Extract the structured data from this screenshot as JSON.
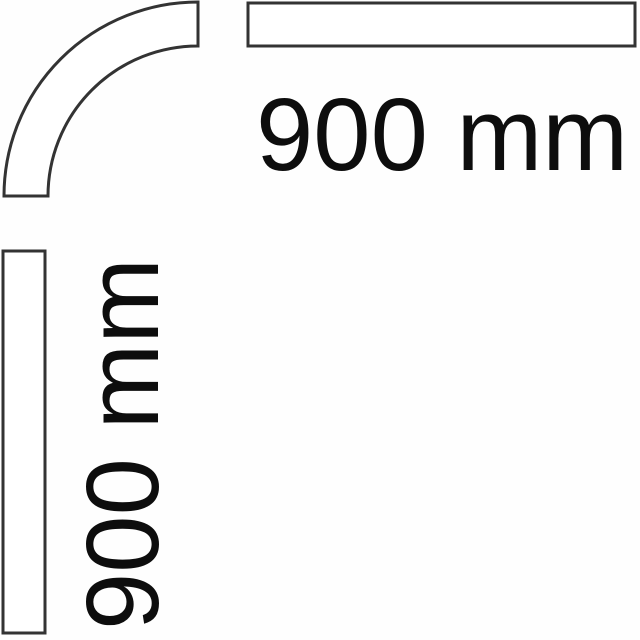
{
  "diagram": {
    "description_labels": {
      "horizontal_dimension": "900 mm",
      "vertical_dimension": "900 mm"
    },
    "colors": {
      "line": "#333333",
      "text": "#0d0d0d",
      "fill": "#ffffff",
      "background": "#fefefe"
    }
  }
}
